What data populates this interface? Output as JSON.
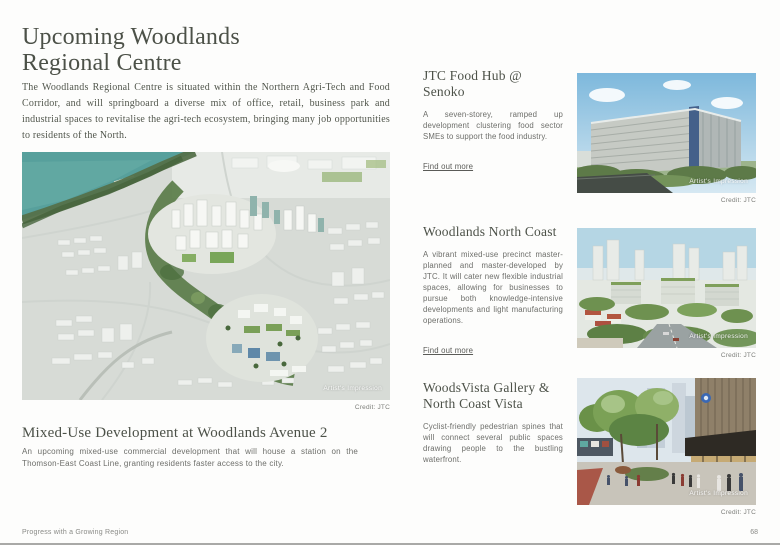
{
  "page": {
    "title": "Upcoming Woodlands Regional Centre",
    "intro": "The Woodlands Regional Centre is situated within the Northern Agri-Tech and Food Corridor, and will springboard a diverse mix of office, retail, business park and industrial spaces to revitalise the agri-tech ecosystem, bringing many job opportunities to residents of the North."
  },
  "feature": {
    "watermark": "Artist's Impression",
    "credit": "Credit: JTC",
    "heading": "Mixed-Use Development at Woodlands Avenue 2",
    "description": "An upcoming mixed-use commercial development that will house a station on the Thomson-East Coast Line, granting residents faster access to the city."
  },
  "sections": [
    {
      "heading": "JTC Food Hub @ Senoko",
      "description": "A seven-storey, ramped up development clustering food sector SMEs to support the food industry.",
      "link_label": "Find out more",
      "watermark": "Artist's Impression",
      "credit": "Credit: JTC"
    },
    {
      "heading": "Woodlands North Coast",
      "description": "A vibrant mixed-use precinct master-planned and master-developed by JTC. It will cater new flexible industrial spaces, allowing for businesses to pursue both knowledge-intensive developments and light manufacturing operations.",
      "link_label": "Find out more",
      "watermark": "Artist's Impression",
      "credit": "Credit: JTC"
    },
    {
      "heading": "WoodsVista Gallery & North Coast Vista",
      "description": "Cyclist-friendly pedestrian spines that will connect several public spaces drawing people to the bustling waterfront.",
      "watermark": "Artist's Impression",
      "credit": "Credit: JTC"
    }
  ],
  "footer": {
    "left_label": "Progress with a Growing Region",
    "page_number": "68"
  },
  "colors": {
    "heading": "#4c5148",
    "body_text": "#6d6e6a",
    "water_teal": "#57a09c"
  }
}
